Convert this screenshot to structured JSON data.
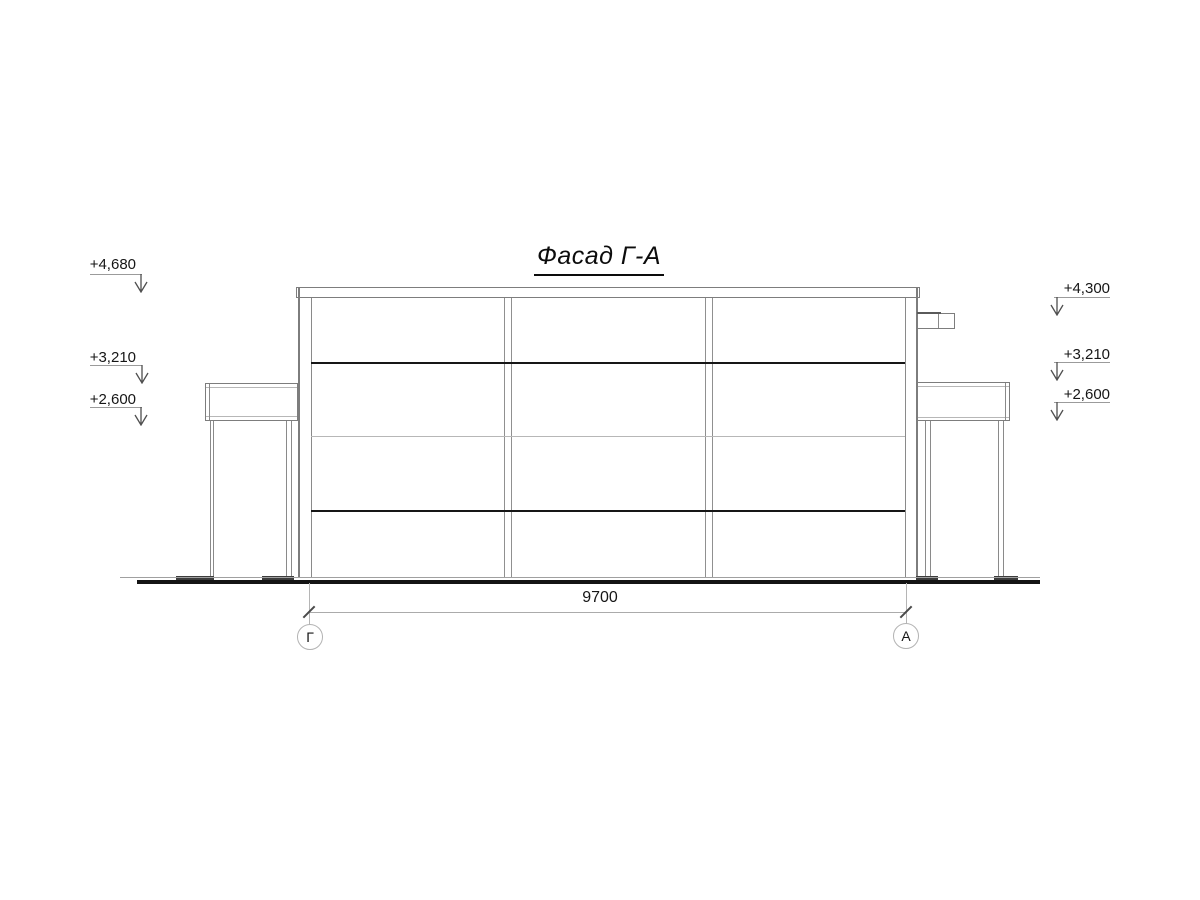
{
  "title": {
    "text": "Фасад Г-А"
  },
  "elevation_marks_left": [
    {
      "value": "+4,680"
    },
    {
      "value": "+3,210"
    },
    {
      "value": "+2,600"
    }
  ],
  "elevation_marks_right": [
    {
      "value": "+4,300"
    },
    {
      "value": "+3,210"
    },
    {
      "value": "+2,600"
    }
  ],
  "dimension": {
    "length_label": "9700"
  },
  "axis_markers": {
    "left": "Г",
    "right": "А"
  },
  "colors": {
    "background": "#ffffff",
    "line_gray": "#8a8a8a",
    "line_dark": "#161616",
    "text": "#111111"
  }
}
